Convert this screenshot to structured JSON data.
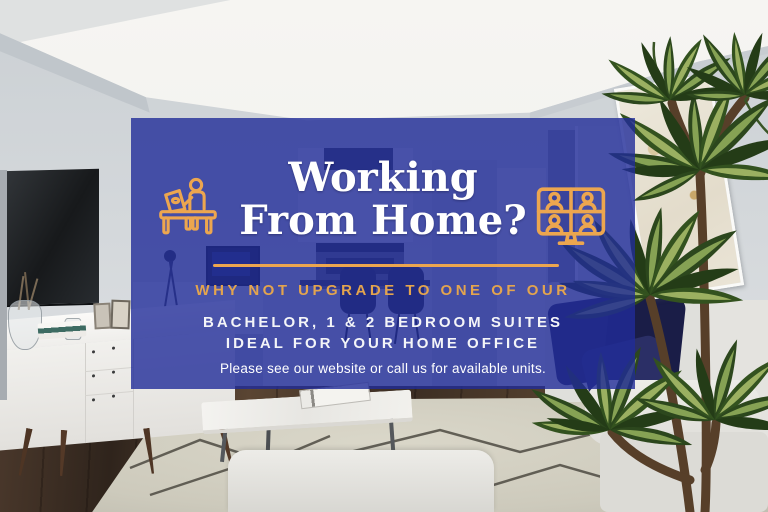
{
  "ad": {
    "headline": {
      "line1": "Working",
      "line2": "From Home?"
    },
    "subheadline": "WHY NOT UPGRADE TO ONE OF OUR",
    "body_line1": "BACHELOR, 1 & 2 BEDROOM SUITES",
    "body_line2": "IDEAL FOR YOUR HOME OFFICE",
    "footer": "Please see our website or call us for available units.",
    "icons": {
      "left": "person-working-at-desk-icon",
      "right": "video-conference-monitor-icon"
    },
    "colors": {
      "overlay_blue": "#202C99",
      "accent_gold": "#ECA64F",
      "text_white": "#FFFFFF"
    }
  },
  "scene": {
    "type": "living-room-photograph",
    "items": [
      "wall-mounted-tv",
      "white-credenza",
      "vase-with-twigs",
      "book-stack",
      "picture-frames",
      "kitchen-with-stove-and-stools",
      "door",
      "marble-coffee-table",
      "magazine",
      "area-rug",
      "foreground-bench",
      "sofa-with-navy-pillows",
      "framed-abstract-art",
      "potted-dracaena-plant",
      "dark-wood-floor"
    ]
  }
}
